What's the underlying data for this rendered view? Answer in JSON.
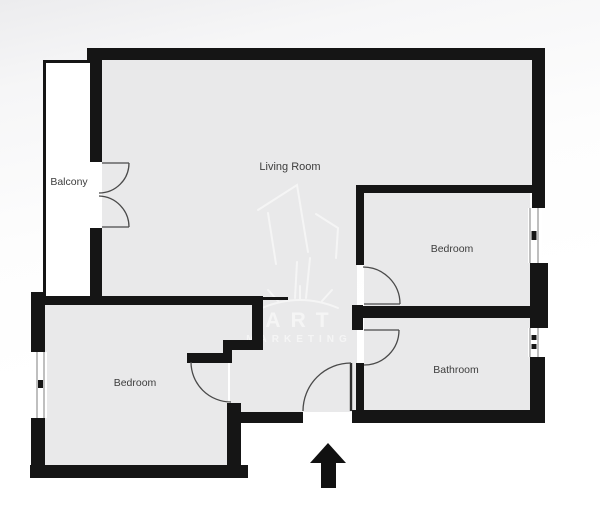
{
  "floorplan": {
    "title": "Apartment floor plan",
    "rooms": [
      {
        "label": "Balcony"
      },
      {
        "label": "Living Room"
      },
      {
        "label": "Bedroom"
      },
      {
        "label": "Bedroom"
      },
      {
        "label": "Bathroom"
      }
    ],
    "watermark": {
      "line1": "ART",
      "line2": "MARKETING"
    },
    "entrance": {
      "symbol": "arrow",
      "direction": "up"
    },
    "features": {
      "balcony_doors": "double french doors",
      "interior_doors": 3,
      "windows": 3
    },
    "colors": {
      "wall": "#151515",
      "floor": "#e9e9ea",
      "door": "#4a4a4a",
      "label": "#3d3d3d",
      "watermark": "#ffffff",
      "arrow": "#111111"
    }
  }
}
